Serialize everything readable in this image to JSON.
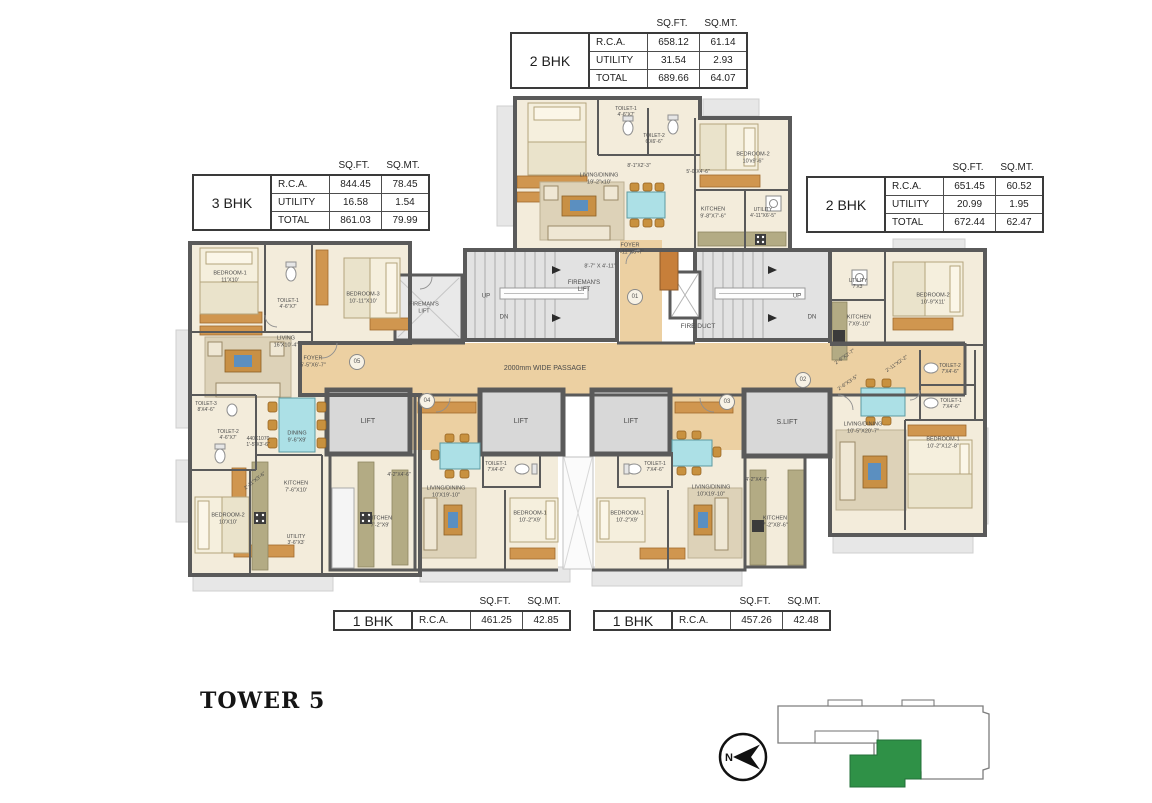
{
  "title": {
    "tower": "TOWER 5"
  },
  "colors": {
    "highlight_green": "#2f9147",
    "wall": "#5a5a5a",
    "passage_tan": "#ecd0a2"
  },
  "north": {
    "letter": "N"
  },
  "tables": [
    {
      "id": "2bhk-top",
      "bhk": "2 BHK",
      "x": 510,
      "y": 18,
      "col_headers": [
        "SQ.FT.",
        "SQ.MT."
      ],
      "rows": [
        [
          "R.C.A.",
          "658.12",
          "61.14"
        ],
        [
          "UTILITY",
          "31.54",
          "2.93"
        ],
        [
          "TOTAL",
          "689.66",
          "64.07"
        ]
      ]
    },
    {
      "id": "3bhk-left",
      "bhk": "3 BHK",
      "x": 192,
      "y": 160,
      "col_headers": [
        "SQ.FT.",
        "SQ.MT."
      ],
      "rows": [
        [
          "R.C.A.",
          "844.45",
          "78.45"
        ],
        [
          "UTILITY",
          "16.58",
          "1.54"
        ],
        [
          "TOTAL",
          "861.03",
          "79.99"
        ]
      ]
    },
    {
      "id": "2bhk-right",
      "bhk": "2 BHK",
      "x": 806,
      "y": 162,
      "col_headers": [
        "SQ.FT.",
        "SQ.MT."
      ],
      "rows": [
        [
          "R.C.A.",
          "651.45",
          "60.52"
        ],
        [
          "UTILITY",
          "20.99",
          "1.95"
        ],
        [
          "TOTAL",
          "672.44",
          "62.47"
        ]
      ]
    },
    {
      "id": "1bhk-left",
      "bhk": "1 BHK",
      "x": 333,
      "y": 596,
      "col_headers": [
        "SQ.FT.",
        "SQ.MT."
      ],
      "rows": [
        [
          "R.C.A.",
          "461.25",
          "42.85"
        ]
      ]
    },
    {
      "id": "1bhk-right",
      "bhk": "1 BHK",
      "x": 593,
      "y": 596,
      "col_headers": [
        "SQ.FT.",
        "SQ.MT."
      ],
      "rows": [
        [
          "R.C.A.",
          "457.26",
          "42.48"
        ]
      ]
    }
  ],
  "plan": {
    "units": [
      {
        "num": "01",
        "x": 635,
        "y": 297
      },
      {
        "num": "02",
        "x": 803,
        "y": 380
      },
      {
        "num": "03",
        "x": 727,
        "y": 402
      },
      {
        "num": "04",
        "x": 427,
        "y": 401
      },
      {
        "num": "05",
        "x": 357,
        "y": 362
      }
    ],
    "labels": [
      {
        "n": "passage-label",
        "t": "2000mm WIDE PASSAGE",
        "x": 545,
        "y": 369,
        "fs": 7
      },
      {
        "n": "fire-duct-label",
        "t": "FIRE DUCT",
        "x": 698,
        "y": 327,
        "fs": 6.5
      },
      {
        "n": "firemans-lift-room-label",
        "t": "FIREMAN'S\nLIFT",
        "x": 424,
        "y": 308,
        "fs": 5.5
      },
      {
        "n": "firemans-lift-label",
        "t": "FIREMAN'S\nLIFT",
        "x": 584,
        "y": 287,
        "fs": 6
      },
      {
        "n": "stair-up-left",
        "t": "UP",
        "x": 486,
        "y": 297,
        "fs": 6
      },
      {
        "n": "stair-dn-left",
        "t": "DN",
        "x": 504,
        "y": 318,
        "fs": 6
      },
      {
        "n": "stair-up-right",
        "t": "UP",
        "x": 797,
        "y": 297,
        "fs": 6
      },
      {
        "n": "stair-dn-right",
        "t": "DN",
        "x": 812,
        "y": 318,
        "fs": 6
      },
      {
        "n": "foyer-01-label",
        "t": "FOYER\n6'-11\"X6'-7\"",
        "x": 630,
        "y": 249,
        "fs": 5.5
      },
      {
        "n": "dim-label",
        "t": "8'-7\" X 4'-11\"",
        "x": 600,
        "y": 267,
        "fs": 5.5
      },
      {
        "n": "lift-label",
        "t": "LIFT",
        "x": 368,
        "y": 422,
        "fs": 7
      },
      {
        "n": "lift-label",
        "t": "LIFT",
        "x": 521,
        "y": 422,
        "fs": 7
      },
      {
        "n": "lift-label",
        "t": "LIFT",
        "x": 631,
        "y": 422,
        "fs": 7
      },
      {
        "n": "service-lift-label",
        "t": "S.LIFT",
        "x": 787,
        "y": 423,
        "fs": 7
      },
      {
        "n": "room-label",
        "t": "TOILET-1\n4'-6\"X7'",
        "x": 626,
        "y": 112,
        "fs": 5
      },
      {
        "n": "room-label",
        "t": "TOILET-2\n6'X6'-6\"",
        "x": 654,
        "y": 139,
        "fs": 5
      },
      {
        "n": "room-label",
        "t": "BEDROOM-2\n10'x9'-6\"",
        "x": 753,
        "y": 158,
        "fs": 5.5
      },
      {
        "n": "room-label",
        "t": "LIVING/DINING\n19'-2\"x10'",
        "x": 599,
        "y": 179,
        "fs": 5.5
      },
      {
        "n": "dim-label",
        "t": "8'-1\"X2'-3\"",
        "x": 639,
        "y": 166,
        "fs": 5
      },
      {
        "n": "dim-label",
        "t": "5'-0\"X4'-6\"",
        "x": 698,
        "y": 172,
        "fs": 5
      },
      {
        "n": "room-label",
        "t": "KITCHEN\n9'-8\"X7'-6\"",
        "x": 713,
        "y": 213,
        "fs": 5.5
      },
      {
        "n": "room-label",
        "t": "UTILITY\n4'-11\"X6'-5\"",
        "x": 763,
        "y": 213,
        "fs": 5
      },
      {
        "n": "room-label",
        "t": "BEDROOM-1\n11'X10'",
        "x": 230,
        "y": 277,
        "fs": 5.5
      },
      {
        "n": "room-label",
        "t": "TOILET-1\n4'-6\"X7'",
        "x": 288,
        "y": 304,
        "fs": 5
      },
      {
        "n": "room-label",
        "t": "BEDROOM-3\n10'-11\"X10'",
        "x": 363,
        "y": 298,
        "fs": 5.5
      },
      {
        "n": "room-label",
        "t": "LIVING\n16'X10'-4\"",
        "x": 286,
        "y": 342,
        "fs": 5.5
      },
      {
        "n": "room-label",
        "t": "FOYER\n5'-5\"X6'-7\"",
        "x": 313,
        "y": 362,
        "fs": 5.5
      },
      {
        "n": "room-label",
        "t": "TOILET-3\n8'X4'-6\"",
        "x": 206,
        "y": 407,
        "fs": 5
      },
      {
        "n": "room-label",
        "t": "TOILET-2\n4'-6\"X7'",
        "x": 228,
        "y": 435,
        "fs": 5
      },
      {
        "n": "dim-label",
        "t": "440X1070\n1'-5\"X3'-6\"",
        "x": 258,
        "y": 442,
        "fs": 5
      },
      {
        "n": "room-label",
        "t": "DINING\n9'-6\"X9'",
        "x": 297,
        "y": 437,
        "fs": 5.5
      },
      {
        "n": "dim-label",
        "t": "2'-11\"X3'-6\"",
        "x": 255,
        "y": 481,
        "fs": 5,
        "r": -38
      },
      {
        "n": "room-label",
        "t": "KITCHEN\n7'-6\"X10'",
        "x": 296,
        "y": 487,
        "fs": 5.5
      },
      {
        "n": "room-label",
        "t": "BEDROOM-2\n10'X10'",
        "x": 228,
        "y": 519,
        "fs": 5.5
      },
      {
        "n": "room-label",
        "t": "UTILITY\n3'-6\"X3'",
        "x": 296,
        "y": 540,
        "fs": 5
      },
      {
        "n": "room-label",
        "t": "KITCHEN\n7'-2\"X9'",
        "x": 380,
        "y": 522,
        "fs": 5.5
      },
      {
        "n": "dim-label",
        "t": "4'-2\"X4'-6\"",
        "x": 399,
        "y": 475,
        "fs": 5
      },
      {
        "n": "room-label",
        "t": "TOILET-1\n7'X4'-6\"",
        "x": 496,
        "y": 467,
        "fs": 5
      },
      {
        "n": "room-label",
        "t": "LIVING/DINING\n10'X19'-10\"",
        "x": 446,
        "y": 492,
        "fs": 5.5
      },
      {
        "n": "room-label",
        "t": "BEDROOM-1\n10'-2\"X9'",
        "x": 530,
        "y": 517,
        "fs": 5.5
      },
      {
        "n": "room-label",
        "t": "TOILET-1\n7'X4'-6\"",
        "x": 655,
        "y": 467,
        "fs": 5
      },
      {
        "n": "room-label",
        "t": "LIVING/DINING\n10'X19'-10\"",
        "x": 711,
        "y": 491,
        "fs": 5.5
      },
      {
        "n": "room-label",
        "t": "BEDROOM-1\n10'-2\"X9'",
        "x": 627,
        "y": 517,
        "fs": 5.5
      },
      {
        "n": "room-label",
        "t": "KITCHEN\n7'-2\"X8'-6\"",
        "x": 775,
        "y": 522,
        "fs": 5.5
      },
      {
        "n": "dim-label",
        "t": "4'-2\"X4'-6\"",
        "x": 757,
        "y": 480,
        "fs": 5
      },
      {
        "n": "room-label",
        "t": "UTILITY\n7'X3'",
        "x": 858,
        "y": 284,
        "fs": 5
      },
      {
        "n": "room-label",
        "t": "KITCHEN\n7'X9'-10\"",
        "x": 859,
        "y": 321,
        "fs": 5.5
      },
      {
        "n": "room-label",
        "t": "BEDROOM-2\n10'-9\"X11'",
        "x": 933,
        "y": 299,
        "fs": 5.5
      },
      {
        "n": "dim-label",
        "t": "2'-6\"X2'-7\"",
        "x": 845,
        "y": 357,
        "fs": 5,
        "r": -35
      },
      {
        "n": "dim-label",
        "t": "2'-11\"X2'-2\"",
        "x": 897,
        "y": 364,
        "fs": 5,
        "r": -35
      },
      {
        "n": "room-label",
        "t": "TOILET-2\n7'X4'-6\"",
        "x": 950,
        "y": 369,
        "fs": 5
      },
      {
        "n": "dim-label",
        "t": "2'-6\"X3'-5\"",
        "x": 848,
        "y": 383,
        "fs": 5,
        "r": -35
      },
      {
        "n": "room-label",
        "t": "TOILET-1\n7'X4'-6\"",
        "x": 951,
        "y": 404,
        "fs": 5
      },
      {
        "n": "room-label",
        "t": "LIVING/DINING\n10'-5\"X20'-7\"",
        "x": 863,
        "y": 428,
        "fs": 5.5
      },
      {
        "n": "room-label",
        "t": "BEDROOM-1\n10'-2\"X12'-8\"",
        "x": 943,
        "y": 443,
        "fs": 5.5
      }
    ]
  }
}
